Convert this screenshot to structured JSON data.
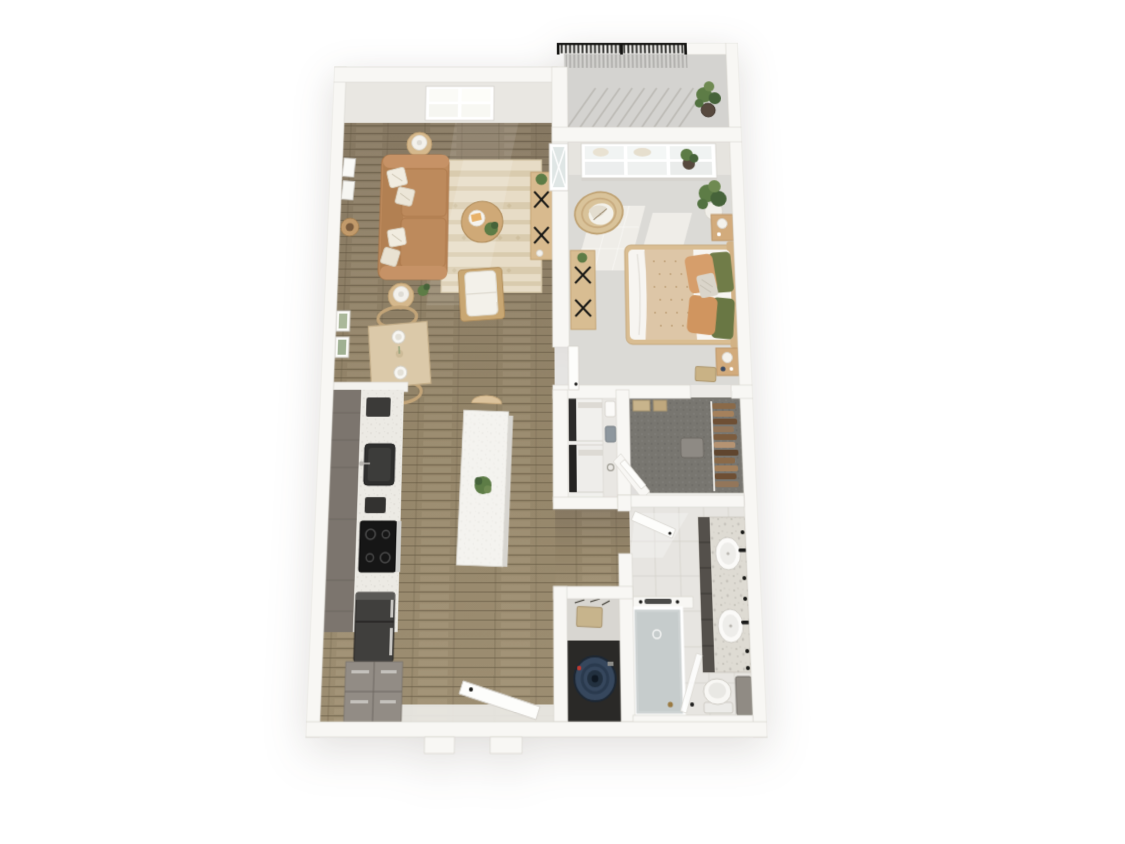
{
  "meta": {
    "title": "3D top-down floor plan render, one-bedroom apartment with balcony",
    "view": "bird's-eye dollhouse perspective",
    "background": "white"
  },
  "rooms": [
    {
      "name": "Balcony",
      "floor": "concrete gray",
      "items": [
        "black metal railing",
        "railing shadow",
        "potted plant"
      ]
    },
    {
      "name": "Living Room",
      "floor": "brown wood planks",
      "items": [
        "tan leather sofa with cream pillows",
        "two round side tables with white lamps",
        "patterned beige area rug",
        "round wood coffee table with tray and plant",
        "white lounge chair",
        "wood media console with black x-legs",
        "wall art frames",
        "round wall basket",
        "bright window on top wall"
      ]
    },
    {
      "name": "Dining Nook",
      "floor": "brown wood planks",
      "items": [
        "square wood dining table",
        "two rattan chairs",
        "two place settings",
        "two botanical wall frames"
      ]
    },
    {
      "name": "Kitchen",
      "floor": "brown wood planks",
      "items": [
        "gray cabinet run with speckled counter",
        "dark undermount sink",
        "black cooktop with oven",
        "dark refrigerator",
        "corner cabinet block",
        "white island with plant and stool"
      ]
    },
    {
      "name": "Bedroom",
      "floor": "light gray carpet",
      "items": [
        "queen bed with white duvet and patterned throw",
        "green and tan pillows",
        "two wood nightstands with lamps",
        "rattan accent chair",
        "wood media console with black x-legs",
        "large potted plants",
        "bright paned window",
        "sunlight patches",
        "open white door"
      ]
    },
    {
      "name": "Laundry Closet",
      "floor": "white",
      "items": [
        "stacked washer and dryer",
        "side counter with detergent boxes"
      ]
    },
    {
      "name": "Walk-in Closet",
      "floor": "dark gray carpet",
      "items": [
        "hanging clothes along right wall",
        "beige storage boxes",
        "gray ottoman",
        "angled entry wall"
      ]
    },
    {
      "name": "Bathroom",
      "floor": "light gray tile",
      "items": [
        "double vanity with marble counter",
        "two white oval sinks with black faucets",
        "dark cabinet fronts",
        "white toilet",
        "gray storage cabinet",
        "glass-enclosed tub shower",
        "half wall with towel bar",
        "open white door"
      ]
    },
    {
      "name": "Utility Closet",
      "floor": "dark",
      "items": [
        "navy water heater seen from top",
        "shelf with beige electrical box"
      ]
    },
    {
      "name": "Entry",
      "floor": "white threshold",
      "items": [
        "open white entry door",
        "door threshold tabs in bottom wall"
      ]
    }
  ],
  "palette": {
    "wall": "#f8f7f4",
    "wallEdge": "#d9d6d0",
    "wallFace": "#e9e7e2",
    "wood": "#8f8169",
    "woodDark": "#6f6350",
    "woodLight": "#a79878",
    "carpet": "#dbdad6",
    "carpetSun": "#efede8",
    "closetCarpet": "#787670",
    "tile": "#e7e5e1",
    "tileGrout": "#d3d0ca",
    "balconyFloor": "#d4d3d0",
    "railing": "#1a1a18",
    "sofa": "#bd8a5c",
    "sofaDark": "#a87548",
    "rug": "#e7dcc6",
    "rugBand": "#d9cbae",
    "oak": "#d5b88c",
    "oakDark": "#c2a273",
    "cabinet": "#928c85",
    "cabinetDark": "#7c756e",
    "counter": "#eceae4",
    "marble": "#dedbd3",
    "vanityDark": "#54504b",
    "appliance": "#2e2d2c",
    "waterHeater": "#36475d",
    "plant": "#5d7c46",
    "plantDark": "#46633a",
    "pillowGreen": "#707c48",
    "pillowTan": "#d69e6b",
    "throwBlanket": "#ddc6a7",
    "glass": "#c6cccc",
    "white": "#f6f5f1"
  }
}
